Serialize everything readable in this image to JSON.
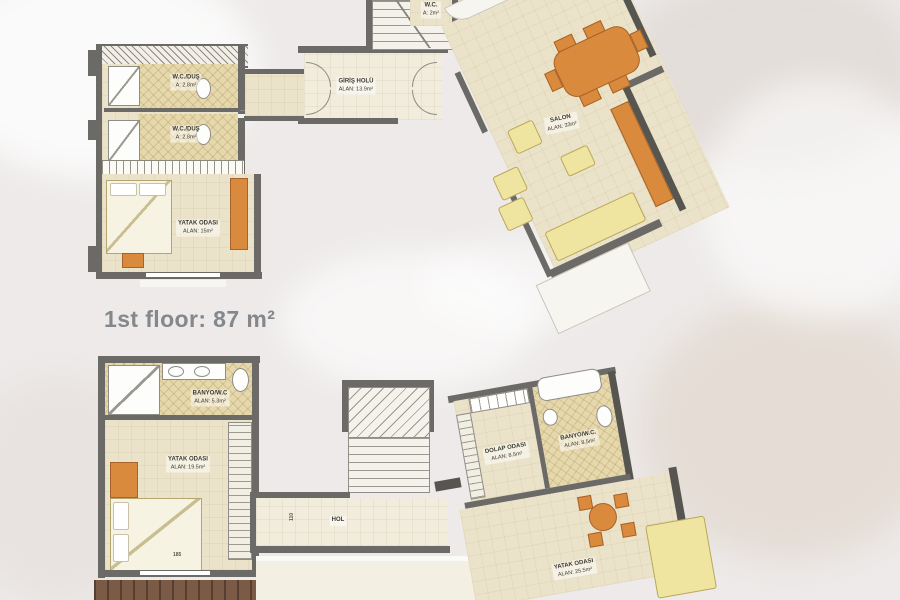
{
  "floor_title": "1st floor: 87 m²",
  "ground_floor": {
    "wc_shower_1": {
      "name": "W.C./DUŞ",
      "area": "A: 2.8m²"
    },
    "wc_shower_2": {
      "name": "W.C./DUŞ",
      "area": "A: 2.8m²"
    },
    "bedroom": {
      "name": "YATAK ODASI",
      "area": "ALAN: 15m²"
    },
    "entrance_hall": {
      "name": "GİRİŞ HOLÜ",
      "area": "ALAN: 13.9m²"
    },
    "salon": {
      "name": "SALON",
      "area": "ALAN: 33m²"
    },
    "wc_top": {
      "name": "W.C.",
      "area": "A: 2m²"
    },
    "top_bath": {
      "area": "A: 3.4m²"
    }
  },
  "first_floor": {
    "bathroom_left": {
      "name": "BANYO/W.C",
      "area": "ALAN: 5.3m²"
    },
    "bedroom_left": {
      "name": "YATAK ODASI",
      "area": "ALAN: 19.5m²"
    },
    "hall": {
      "name": "HOL"
    },
    "closet_room": {
      "name": "DOLAP ODASI",
      "area": "ALAN: 8.5m²"
    },
    "bathroom_right": {
      "name": "BANYO/W.C.",
      "area": "ALAN: 8.5m²"
    },
    "bedroom_right": {
      "name": "YATAK ODASI",
      "area": "ALAN: 25.5m²"
    },
    "dimensions": {
      "bedroom_width": "185",
      "hall_width": "110"
    }
  },
  "colors": {
    "wall": "#6c6a66",
    "floor_cream": "#ebe3c9",
    "tile_beige": "#e6d8ad",
    "furniture_orange": "#d98a3c",
    "sofa_yellow": "#efe5a0",
    "deck_brown": "#7b5a46",
    "title_text": "#84878b"
  }
}
